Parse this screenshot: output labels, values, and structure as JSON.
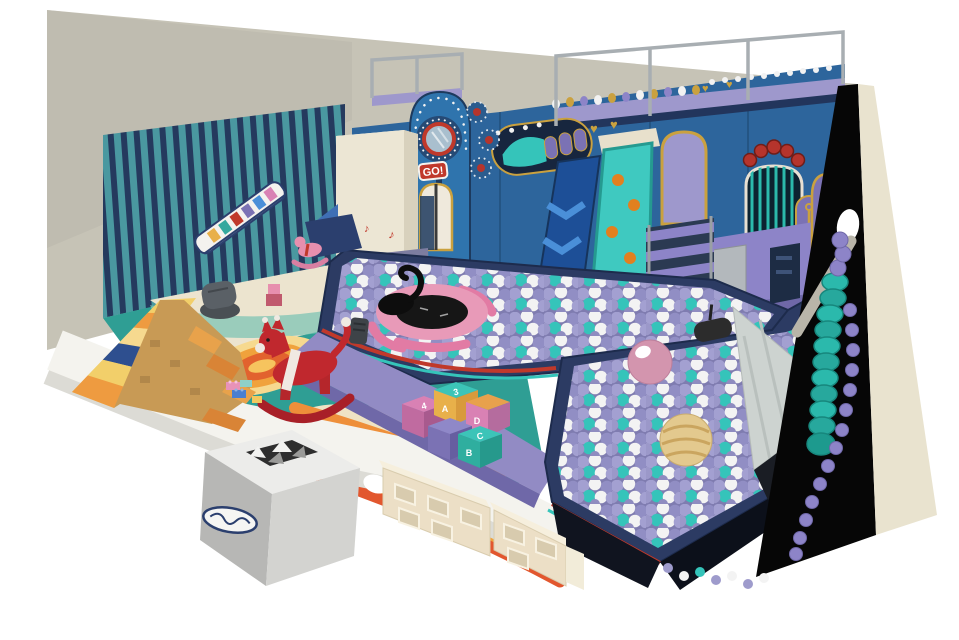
{
  "image": {
    "type": "3d-render",
    "subject": "indoor children's soft play center, isometric cutaway view",
    "canvas_w": 959,
    "canvas_h": 640
  },
  "signs": {
    "go": "GO!"
  },
  "icons": {
    "music_note": "♪",
    "heart": "♥",
    "brand_logo": "illegible stylized logo on reception box",
    "up_triangle": "▲"
  },
  "blocks": [
    {
      "top": "4",
      "front": ""
    },
    {
      "top": "3",
      "front": "A"
    },
    {
      "top": "",
      "front": "D"
    },
    {
      "top": "",
      "front": ""
    },
    {
      "top": "C",
      "front": "B"
    }
  ],
  "palette": {
    "background": "#ffffff",
    "back_wall": "#c6c3b6",
    "back_wall_left_tint": "#bbb8ab",
    "cut_wall_black": "#060606",
    "wall_edge_beige": "#e9e3cf",
    "wallpaper_teal": "#4a98a0",
    "wallpaper_navy": "#253a5e",
    "floor_teal": "#2f9e94",
    "floor_cream": "#ece4cf",
    "swirl_yellow": "#f6d98f",
    "swirl_orange": "#f0a23c",
    "swirl_red": "#e2622e",
    "sand": "#efe3c4",
    "walkway_white": "#f4f3ee",
    "structure_blue": "#2d659c",
    "structure_navy": "#1d3a5e",
    "deck_purple": "#9e98cc",
    "stair_purple": "#8d84c8",
    "slide_blue": "#1d4f97",
    "slide_chevron": "#4a8fd8",
    "ramp_teal": "#3fc9c0",
    "ramp_hole_orange": "#e2801f",
    "gold": "#caa13f",
    "red": "#c0392b",
    "pit_navy": "#2c3b63",
    "ball_lavender": "#9e9bcc",
    "ball_white": "#f3f3f3",
    "ball_teal": "#35c4ba",
    "trampoline_pink": "#e89ab8",
    "big_ball_pink": "#d395ae",
    "big_ball_yellow": "#e3c98e",
    "wide_slide_gray": "#cdd3d0",
    "caterpillar_teal": "#2bb9ac",
    "pyramid_yellow": "#f2cf6a",
    "pyramid_orange": "#ee9b40",
    "pyramid_navy": "#2e4f8f",
    "horse_red": "#c0282e",
    "toy_pink": "#e78fae",
    "fence_beige": "#ecdfc6",
    "box_gray": "#c0c0be",
    "frame_gray": "#a8aeb2"
  },
  "inventory": [
    "ball pit filled with lavender, white and teal balls (two connected pools)",
    "pink trampoline with black jump mat set into ball pit",
    "black swan inflatable in ball pit",
    "giant pink ball and giant striped yellow ball in lower pit",
    "dark punching-bag toy in ball pit",
    "blue play tower with porthole window, red GO! sign and gold arched door",
    "flower/petal porthole medallions beside tower",
    "ball-run track panel with gold frame and purple wickets",
    "navy straight slide with light blue chevrons",
    "teal climbing ramp with orange hand holds and cream top platform",
    "purple staircase with dark treads",
    "gold framed purple arch window",
    "barred arch window with red scallop crown decoration",
    "purple capsule panel with gold anchor motif",
    "gray mesh panel and dark service door under right deck",
    "decorative stud rows, gold hearts on blue facade",
    "gray steel support frame above structure",
    "gray wide slide into ball pit with support strut and wall light",
    "teal caterpillar tube and purple knob rail on right edge",
    "striped teal and navy wallpaper with train mural on left wall",
    "soft climbing pyramid of yellow, orange and navy striped blocks with steps",
    "dark gray bean bag",
    "red rocking horse with white stripe",
    "small pink rocking horse and pink block toy",
    "blue wedge mat and navy play mat",
    "cream support column with red music notes and stacking-ring toy boards",
    "alphabet play blocks lettered 4, 3, A, D, C, B",
    "small toy bricks on floor",
    "beige cubby-hole fence panels along walkway",
    "gray reception box with pinwheel opening and brand logo",
    "white walkway slab around colorful teal floor with orange swirl and rainbow stripes",
    "right wall shown cut away in black with beige cut edge"
  ]
}
